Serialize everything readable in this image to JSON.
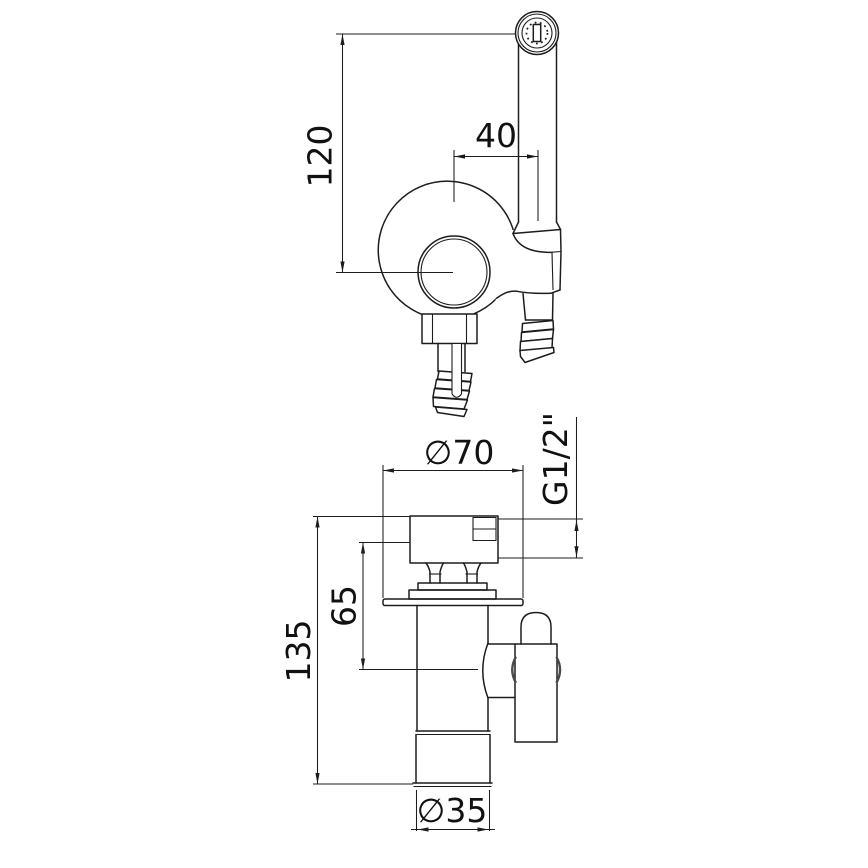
{
  "drawing": {
    "background": "#ffffff",
    "line_color": "#1d1d1d",
    "views": {
      "top_view": {
        "dimensions": {
          "offset_120": "120",
          "offset_40": "40"
        }
      },
      "front_view": {
        "dimensions": {
          "dia_70": "∅70",
          "thread": "G1/2\"",
          "offset_65": "65",
          "height_135": "135",
          "dia_35": "∅35"
        }
      }
    }
  }
}
